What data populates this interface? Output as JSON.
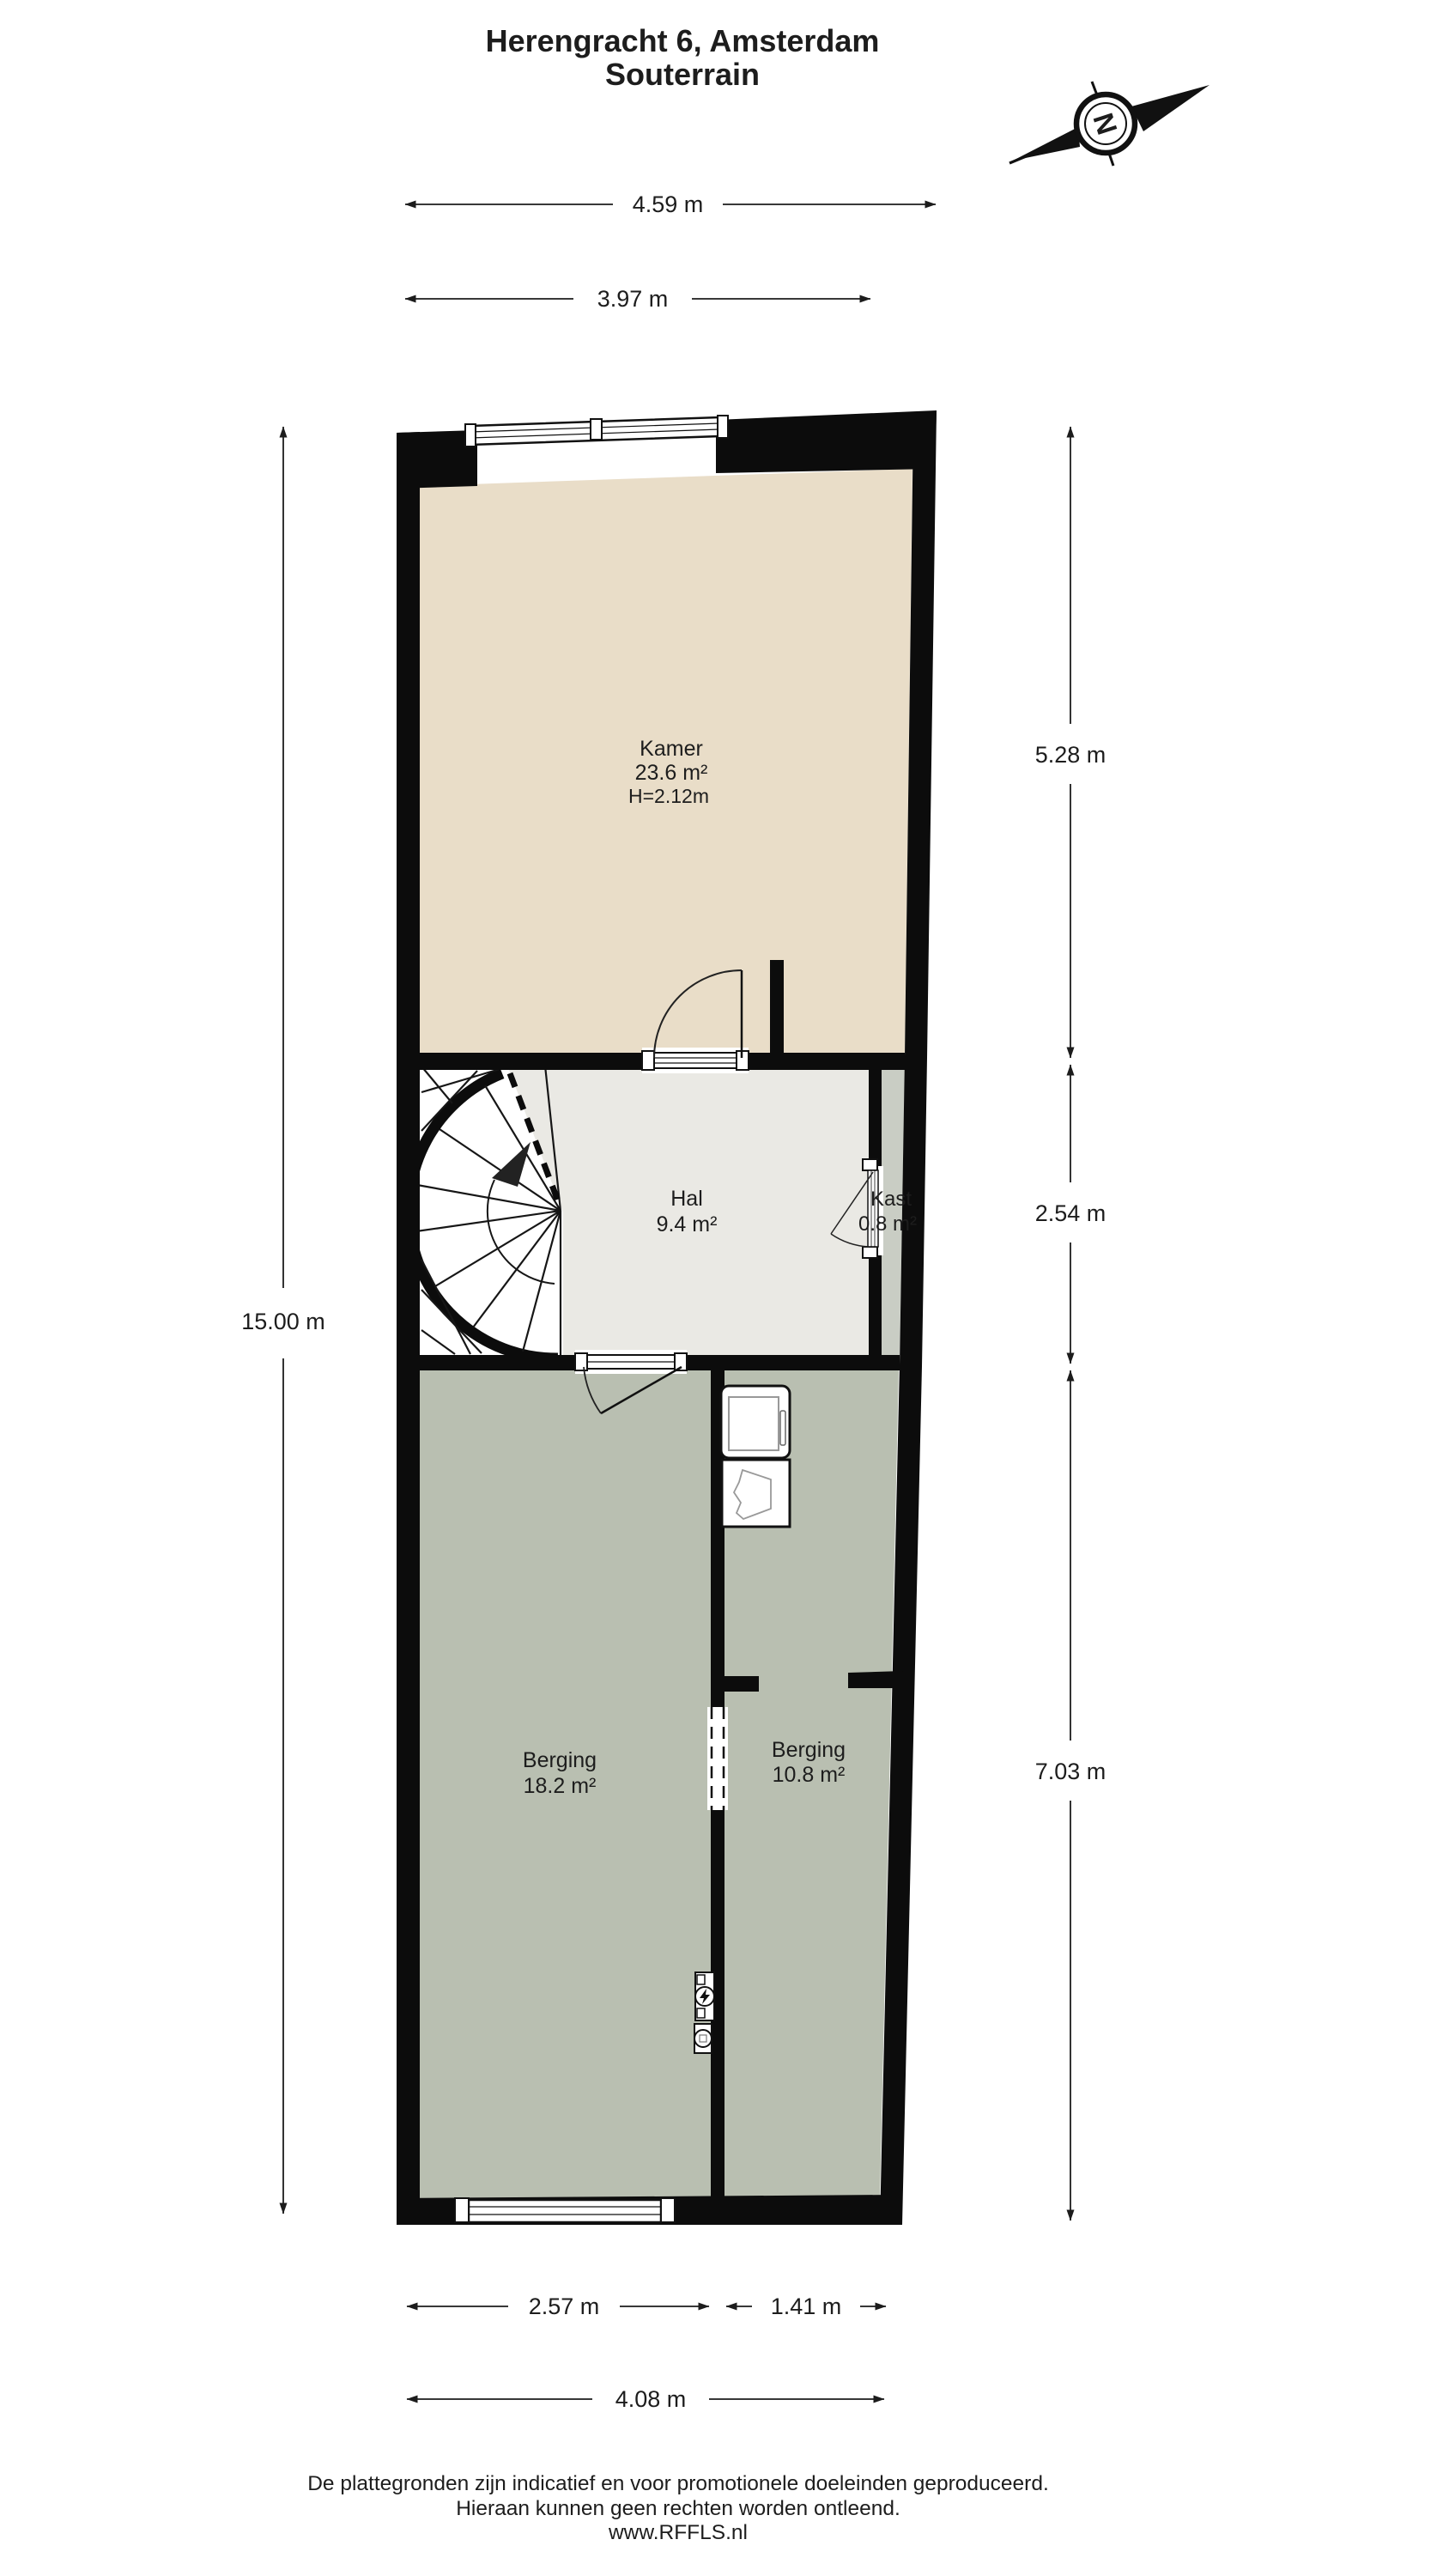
{
  "title": {
    "line1": "Herengracht 6, Amsterdam",
    "line2": "Souterrain"
  },
  "compass": {
    "north_label": "N"
  },
  "rooms": {
    "kamer": {
      "name": "Kamer",
      "area": "23.6 m²",
      "ceiling_height": "H=2.12m"
    },
    "hal": {
      "name": "Hal",
      "area": "9.4 m²"
    },
    "kast": {
      "name": "Kast",
      "area": "0.8 m²"
    },
    "berging_left": {
      "name": "Berging",
      "area": "18.2 m²"
    },
    "berging_right": {
      "name": "Berging",
      "area": "10.8 m²"
    }
  },
  "dimensions": {
    "top_outer": "4.59 m",
    "top_inner": "3.97 m",
    "left_total": "15.00 m",
    "right_top": "5.28 m",
    "right_middle": "2.54 m",
    "right_bottom": "7.03 m",
    "bottom_left": "2.57 m",
    "bottom_right": "1.41 m",
    "bottom_total": "4.08 m"
  },
  "footer": {
    "line1": "De plattegronden zijn indicatief en voor promotionele doeleinden geproduceerd.",
    "line2": "Hieraan kunnen geen rechten worden ontleend.",
    "line3": "www.RFFLS.nl"
  },
  "colors": {
    "kamer": "#e9ddc8",
    "hal": "#eae9e4",
    "kast": "#c9cdc4",
    "berging": "#b9bfb1",
    "wall": "#0c0c0c",
    "white": "#ffffff"
  }
}
